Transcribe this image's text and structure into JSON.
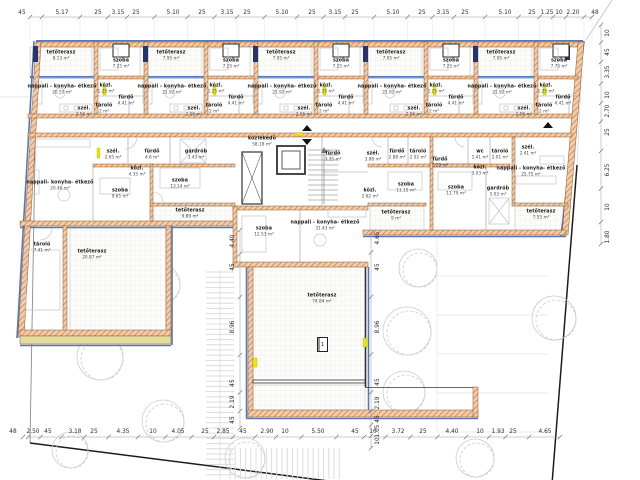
{
  "plan": {
    "marker": {
      "label": "1"
    },
    "colors": {
      "wall_hatch": "#c9793f",
      "wall_fill": "#f3cdaa",
      "insulation_blue": "#5577bb",
      "window_navy": "#26356b",
      "accent_yellow": "#ede800",
      "paving_tan": "#e3dc9e",
      "tree_line": "#cccccc",
      "dim_line": "#9a9a9a",
      "text_dark": "#1a1a1a"
    },
    "rooms": [
      {
        "n": "tetőterasz",
        "a": "8.13 m²",
        "x": 61,
        "y": 56
      },
      {
        "n": "tetőterasz",
        "a": "7.95 m²",
        "x": 171,
        "y": 56
      },
      {
        "n": "tetőterasz",
        "a": "7.95 m²",
        "x": 281,
        "y": 56
      },
      {
        "n": "tetőterasz",
        "a": "7.95 m²",
        "x": 391,
        "y": 56
      },
      {
        "n": "tetőterasz",
        "a": "7.95 m²",
        "x": 501,
        "y": 56
      },
      {
        "n": "szoba",
        "a": "7.25 m²",
        "x": 121,
        "y": 64
      },
      {
        "n": "szoba",
        "a": "7.25 m²",
        "x": 231,
        "y": 64
      },
      {
        "n": "szoba",
        "a": "7.25 m²",
        "x": 341,
        "y": 64
      },
      {
        "n": "szoba",
        "a": "7.25 m²",
        "x": 451,
        "y": 64
      },
      {
        "n": "szoba",
        "a": "7.75 m²",
        "x": 559,
        "y": 64
      },
      {
        "n": "nappali - konyha- étkező",
        "a": "20.55 m²",
        "x": 62,
        "y": 90
      },
      {
        "n": "nappali - konyha- étkező",
        "a": "21.92 m²",
        "x": 172,
        "y": 90
      },
      {
        "n": "nappali - konyha- étkező",
        "a": "21.92 m²",
        "x": 282,
        "y": 90
      },
      {
        "n": "nappali - konyha- étkező",
        "a": "21.92 m²",
        "x": 392,
        "y": 90
      },
      {
        "n": "nappali - konyha- étkező",
        "a": "21.92 m²",
        "x": 502,
        "y": 90
      },
      {
        "n": "közl.",
        "a": "1.25 m²",
        "x": 106,
        "y": 89
      },
      {
        "n": "közl.",
        "a": "1.25 m²",
        "x": 216,
        "y": 89
      },
      {
        "n": "közl.",
        "a": "1.25 m²",
        "x": 326,
        "y": 89
      },
      {
        "n": "közl.",
        "a": "1.25 m²",
        "x": 436,
        "y": 89
      },
      {
        "n": "közl.",
        "a": "1.25 m²",
        "x": 546,
        "y": 89
      },
      {
        "n": "fürdő",
        "a": "4.41 m²",
        "x": 126,
        "y": 101
      },
      {
        "n": "fürdő",
        "a": "4.41 m²",
        "x": 236,
        "y": 101
      },
      {
        "n": "fürdő",
        "a": "4.41 m²",
        "x": 346,
        "y": 101
      },
      {
        "n": "fürdő",
        "a": "4.41 m²",
        "x": 456,
        "y": 101
      },
      {
        "n": "fürdő",
        "a": "4.41 m²",
        "x": 563,
        "y": 101
      },
      {
        "n": "tároló",
        "a": "2 m²",
        "x": 104,
        "y": 109
      },
      {
        "n": "tároló",
        "a": "2 m²",
        "x": 214,
        "y": 109
      },
      {
        "n": "tároló",
        "a": "2 m²",
        "x": 324,
        "y": 109
      },
      {
        "n": "tároló",
        "a": "2 m²",
        "x": 434,
        "y": 109
      },
      {
        "n": "tároló",
        "a": "2 m²",
        "x": 544,
        "y": 109
      },
      {
        "n": "szél.",
        "a": "2.56 m²",
        "x": 84,
        "y": 112
      },
      {
        "n": "szél.",
        "a": "2.56 m²",
        "x": 194,
        "y": 112
      },
      {
        "n": "szél.",
        "a": "2.56 m²",
        "x": 304,
        "y": 112
      },
      {
        "n": "szél.",
        "a": "2.56 m²",
        "x": 414,
        "y": 112
      },
      {
        "n": "szél.",
        "a": "2.56 m²",
        "x": 524,
        "y": 112
      },
      {
        "n": "közlekedő",
        "a": "58.18 m²",
        "x": 262,
        "y": 142
      },
      {
        "n": "szél.",
        "a": "2.65 m²",
        "x": 113,
        "y": 155
      },
      {
        "n": "fürdő",
        "a": "4.6 m²",
        "x": 152,
        "y": 155
      },
      {
        "n": "gardrób",
        "a": "3.43 m²",
        "x": 196,
        "y": 155
      },
      {
        "n": "közl.",
        "a": "4.35 m²",
        "x": 137,
        "y": 172
      },
      {
        "n": "nappali- konyha- étkező",
        "a": "20.46 m²",
        "x": 60,
        "y": 186
      },
      {
        "n": "szoba",
        "a": "9.65 m²",
        "x": 120,
        "y": 194
      },
      {
        "n": "szoba",
        "a": "13.14 m²",
        "x": 180,
        "y": 184
      },
      {
        "n": "tetőterasz",
        "a": "9.89 m²",
        "x": 190,
        "y": 214
      },
      {
        "n": "tároló",
        "a": "7.41 m²",
        "x": 42,
        "y": 248
      },
      {
        "n": "tetőterasz",
        "a": "20.87 m²",
        "x": 92,
        "y": 255
      },
      {
        "n": "fürdő",
        "a": "3.35 m²",
        "x": 333,
        "y": 157
      },
      {
        "n": "szoba",
        "a": "12.53 m²",
        "x": 264,
        "y": 232
      },
      {
        "n": "nappali - konyha- étkező",
        "a": "31.43 m²",
        "x": 325,
        "y": 226
      },
      {
        "n": "tetőterasz",
        "a": "74.84 m²",
        "x": 322,
        "y": 299
      },
      {
        "n": "szél.",
        "a": "3.88 m²",
        "x": 373,
        "y": 157
      },
      {
        "n": "fürdő",
        "a": "2.88 m²",
        "x": 397,
        "y": 155
      },
      {
        "n": "tároló",
        "a": "2.02 m²",
        "x": 418,
        "y": 155
      },
      {
        "n": "közl.",
        "a": "2.62 m²",
        "x": 370,
        "y": 194
      },
      {
        "n": "szoba",
        "a": "11.15 m²",
        "x": 406,
        "y": 188
      },
      {
        "n": "tetőterasz",
        "a": "9 m²",
        "x": 396,
        "y": 216
      },
      {
        "n": "fürdő",
        "a": "7.29 m²",
        "x": 440,
        "y": 163
      },
      {
        "n": "wc",
        "a": "1.41 m²",
        "x": 480,
        "y": 155
      },
      {
        "n": "tároló",
        "a": "2.01 m²",
        "x": 500,
        "y": 155
      },
      {
        "n": "közl.",
        "a": "3.03 m²",
        "x": 480,
        "y": 171
      },
      {
        "n": "szoba",
        "a": "11.79 m²",
        "x": 456,
        "y": 191
      },
      {
        "n": "gardrób",
        "a": "5.03 m²",
        "x": 498,
        "y": 192
      },
      {
        "n": "szél.",
        "a": "2.41 m²",
        "x": 528,
        "y": 151
      },
      {
        "n": "nappali - konyha- étkező",
        "a": "25.75 m²",
        "x": 531,
        "y": 172
      },
      {
        "n": "tetőterasz",
        "a": "7.55 m²",
        "x": 541,
        "y": 215
      }
    ],
    "dims": {
      "top": {
        "y": 13,
        "line_y": 17,
        "x1": 30,
        "x2": 592,
        "ext": [
          19,
          40
        ],
        "items": [
          {
            "v": "45",
            "x": 22
          },
          {
            "v": "5.17",
            "x": 62
          },
          {
            "v": "25",
            "x": 98
          },
          {
            "v": "3.15",
            "x": 118
          },
          {
            "v": "25",
            "x": 136
          },
          {
            "v": "5.10",
            "x": 173
          },
          {
            "v": "25",
            "x": 202
          },
          {
            "v": "3.15",
            "x": 227
          },
          {
            "v": "25",
            "x": 247
          },
          {
            "v": "5.10",
            "x": 282
          },
          {
            "v": "25",
            "x": 312
          },
          {
            "v": "3.15",
            "x": 335
          },
          {
            "v": "25",
            "x": 355
          },
          {
            "v": "5.10",
            "x": 393
          },
          {
            "v": "25",
            "x": 422
          },
          {
            "v": "3.15",
            "x": 443
          },
          {
            "v": "25",
            "x": 465
          },
          {
            "v": "5.10",
            "x": 505
          },
          {
            "v": "25",
            "x": 532
          },
          {
            "v": "1.25",
            "x": 547
          },
          {
            "v": "10",
            "x": 559
          },
          {
            "v": "2.20",
            "x": 573
          },
          {
            "v": "48",
            "x": 595
          }
        ]
      },
      "bottom": {
        "y": 432,
        "line_y": 437,
        "x1": 28,
        "x2": 560,
        "items": [
          {
            "v": "48",
            "x": 13
          },
          {
            "v": "2.50",
            "x": 33
          },
          {
            "v": "45",
            "x": 48
          },
          {
            "v": "3.18",
            "x": 75
          },
          {
            "v": "25",
            "x": 94
          },
          {
            "v": "4.35",
            "x": 123
          },
          {
            "v": "10",
            "x": 153
          },
          {
            "v": "4.05",
            "x": 178
          },
          {
            "v": "25",
            "x": 205
          },
          {
            "v": "2.85",
            "x": 223
          },
          {
            "v": "45",
            "x": 243
          },
          {
            "v": "2.90",
            "x": 267
          },
          {
            "v": "10",
            "x": 285
          },
          {
            "v": "5.50",
            "x": 318
          },
          {
            "v": "45",
            "x": 355
          },
          {
            "v": "10",
            "x": 373
          },
          {
            "v": "3.72",
            "x": 398
          },
          {
            "v": "25",
            "x": 423
          },
          {
            "v": "4.40",
            "x": 452
          },
          {
            "v": "10",
            "x": 480
          },
          {
            "v": "1.93",
            "x": 498
          },
          {
            "v": "25",
            "x": 513
          },
          {
            "v": "4.65",
            "x": 545
          }
        ]
      },
      "right": {
        "x": 608,
        "line_x": 601,
        "y1": 25,
        "y2": 244,
        "items": [
          {
            "v": "10",
            "y": 33
          },
          {
            "v": "45",
            "y": 52
          },
          {
            "v": "3.35",
            "y": 72
          },
          {
            "v": "10",
            "y": 95
          },
          {
            "v": "2.70",
            "y": 111
          },
          {
            "v": "25",
            "y": 132
          },
          {
            "v": "6.25",
            "y": 170
          },
          {
            "v": "10",
            "y": 207
          },
          {
            "v": "1.80",
            "y": 237
          }
        ]
      },
      "terrace_left": {
        "x": 233,
        "line_x": 240,
        "y1": 230,
        "y2": 428,
        "items": [
          {
            "v": "4.40",
            "y": 241
          },
          {
            "v": "45",
            "y": 267
          },
          {
            "v": "8.96",
            "y": 327
          },
          {
            "v": "45",
            "y": 383
          },
          {
            "v": "2.19",
            "y": 402
          },
          {
            "v": "45",
            "y": 420
          }
        ]
      },
      "terrace_right": {
        "x": 378,
        "line_x": 371,
        "y1": 233,
        "y2": 448,
        "items": [
          {
            "v": "4.65",
            "y": 238
          },
          {
            "v": "45",
            "y": 267
          },
          {
            "v": "8.96",
            "y": 327
          },
          {
            "v": "45",
            "y": 382
          },
          {
            "v": "2.19",
            "y": 403
          },
          {
            "v": "45",
            "y": 419
          },
          {
            "v": "1.05",
            "y": 431
          },
          {
            "v": "10",
            "y": 441
          }
        ]
      }
    }
  }
}
